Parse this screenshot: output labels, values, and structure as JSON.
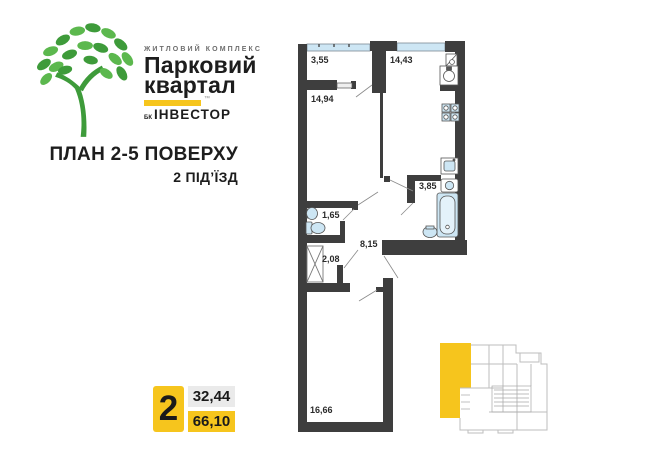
{
  "logo": {
    "complex_type": "ЖИТЛОВИЙ КОМПЛЕКС",
    "name_line1": "Парковий",
    "name_line2": "квартал",
    "trademark": "™",
    "developer_prefix": "БК",
    "developer": "ІНВЕСТОР"
  },
  "title": {
    "plan": "ПЛАН 2-5 ПОВЕРХУ",
    "entrance": "2 ПІД’ЇЗД"
  },
  "apartment": {
    "rooms_count": "2",
    "living_area": "32,44",
    "total_area": "66,10"
  },
  "plan": {
    "rooms": {
      "balcony": {
        "area": "3,55"
      },
      "bedroom": {
        "area": "14,94"
      },
      "kitchen": {
        "area": "14,43"
      },
      "wc": {
        "area": "1,65"
      },
      "bathroom": {
        "area": "3,85"
      },
      "hallway": {
        "area": "8,15"
      },
      "closet": {
        "area": "2,08"
      },
      "living_room": {
        "area": "16,66"
      }
    }
  },
  "colors": {
    "accent_yellow": "#F6C51D",
    "wall_dark": "#3E3E3E",
    "window_blue": "#CDE6F4",
    "tree_green_dark": "#3E9B3A",
    "tree_green_light": "#5CB84E",
    "mini_plan_gray": "#BDBDBD",
    "area_box_gray": "#EAEAEA"
  }
}
